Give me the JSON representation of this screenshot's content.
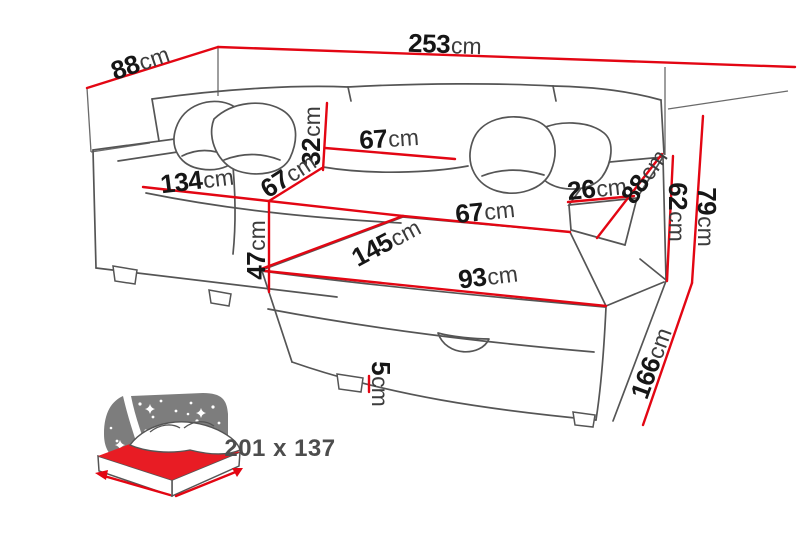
{
  "diagram": {
    "type": "corner-sofa-dimension-drawing",
    "colors": {
      "dimension_line": "#e30613",
      "outline": "#555555",
      "label_number": "#161616",
      "label_unit": "#3c3c3c",
      "icon_gray": "#7d7d7d",
      "icon_red": "#e81c24",
      "background": "#ffffff"
    },
    "dimensions": {
      "depth_overall": {
        "value": "88",
        "unit": "cm"
      },
      "width_overall": {
        "value": "253",
        "unit": "cm"
      },
      "backrest_cushion_height": {
        "value": "32",
        "unit": "cm"
      },
      "backrest_cushion_width": {
        "value": "67",
        "unit": "cm"
      },
      "seat_depth": {
        "value": "67",
        "unit": "cm"
      },
      "seat_width": {
        "value": "134",
        "unit": "cm"
      },
      "seat_height": {
        "value": "47",
        "unit": "cm"
      },
      "chaise_length": {
        "value": "145",
        "unit": "cm"
      },
      "chaise_seat_width": {
        "value": "67",
        "unit": "cm"
      },
      "chaise_front_width": {
        "value": "93",
        "unit": "cm"
      },
      "armrest_width": {
        "value": "26",
        "unit": "cm"
      },
      "armrest_depth": {
        "value": "88",
        "unit": "cm"
      },
      "armrest_height": {
        "value": "62",
        "unit": "cm"
      },
      "height_overall": {
        "value": "79",
        "unit": "cm"
      },
      "side_depth": {
        "value": "166",
        "unit": "cm"
      },
      "leg_height": {
        "value": "5",
        "unit": "cm"
      }
    },
    "sleeping_area": {
      "size_label": "201 x 137"
    }
  }
}
